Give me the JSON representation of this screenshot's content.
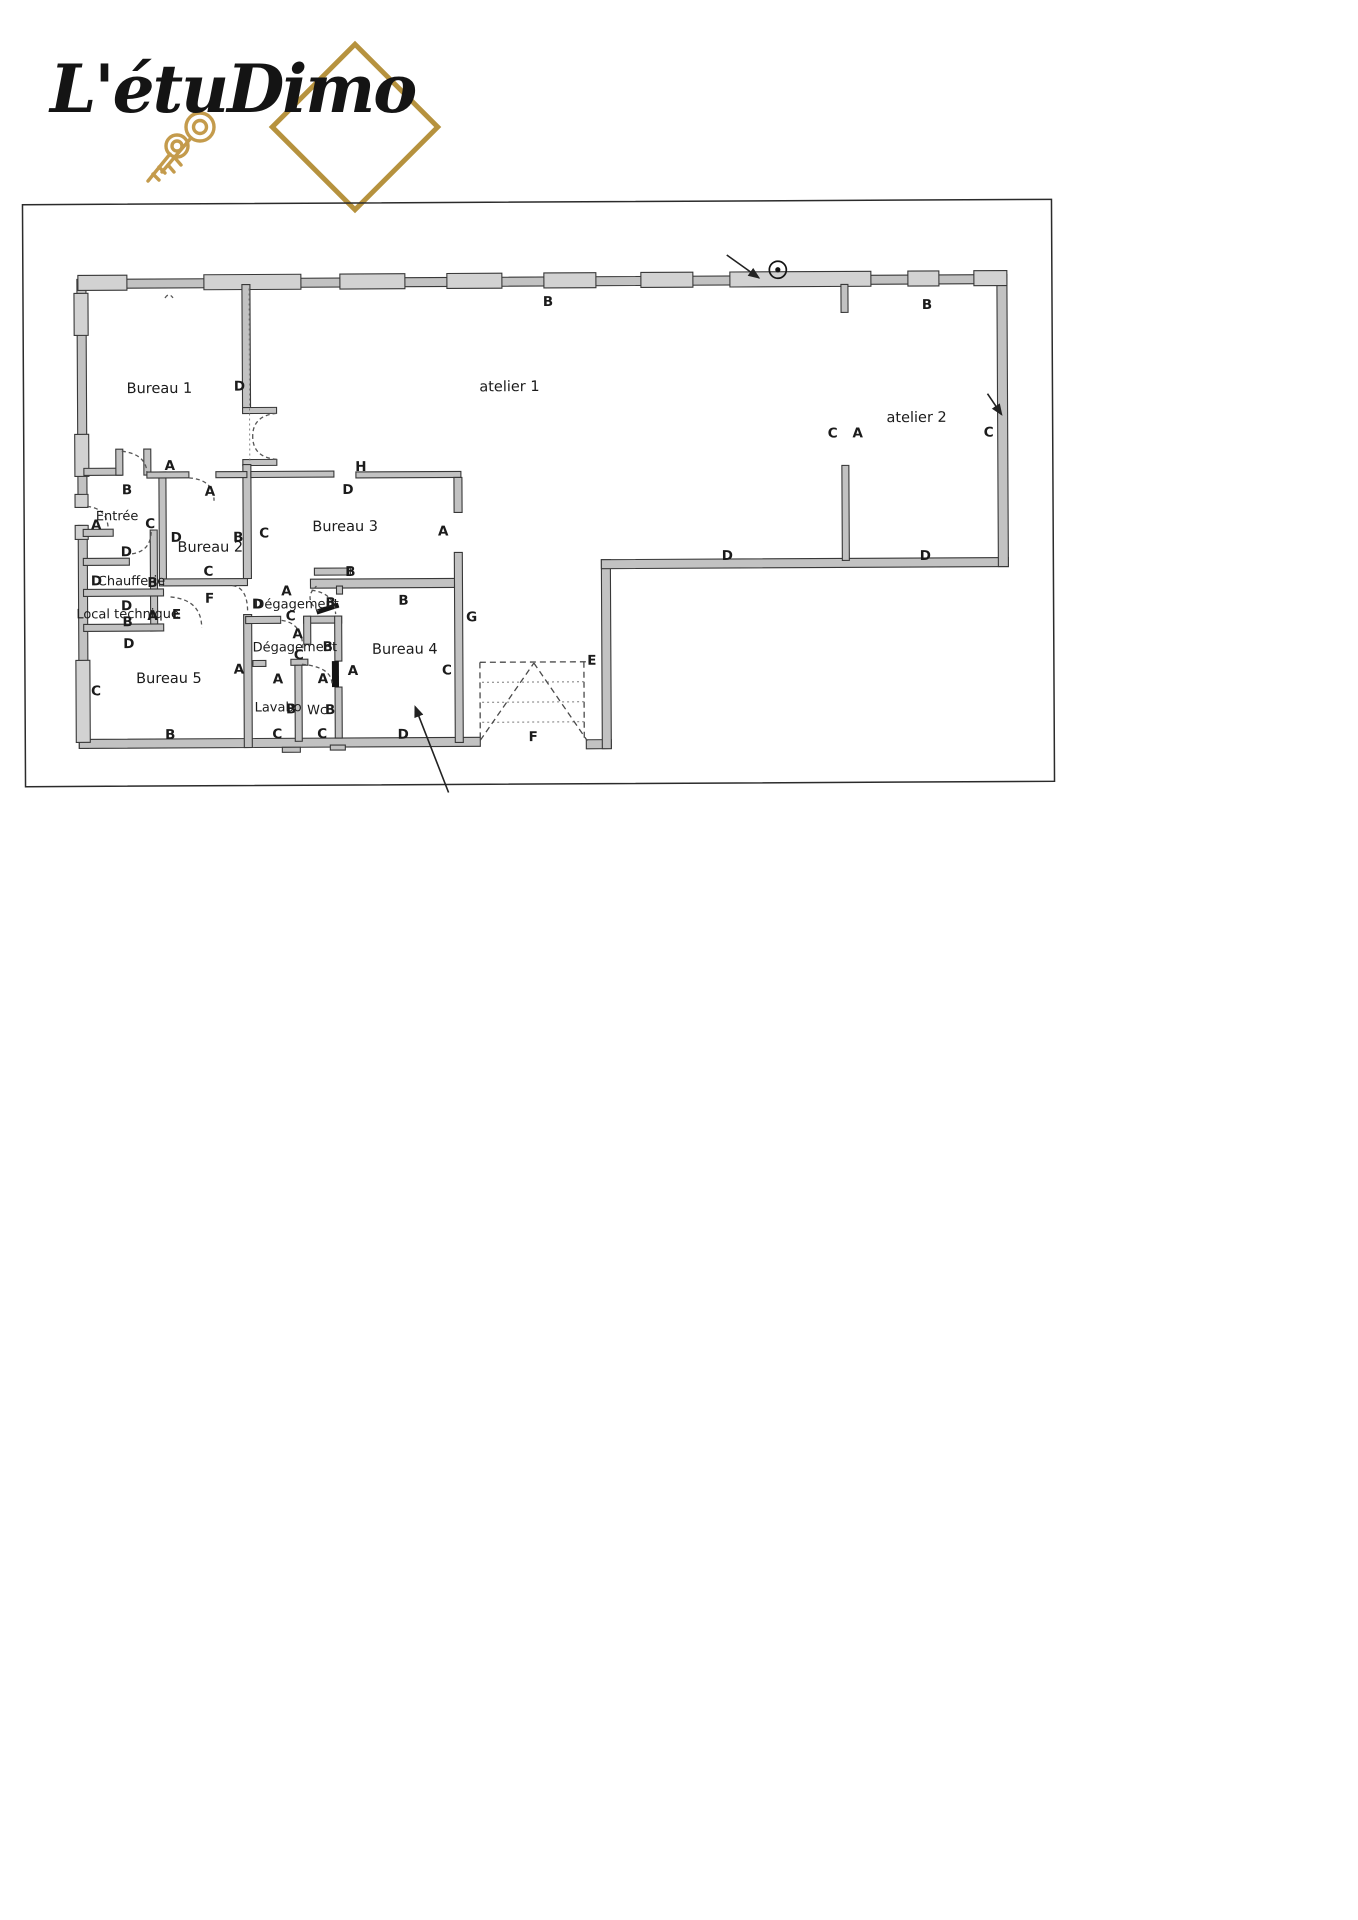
{
  "logo": {
    "text": "L'étuDimo"
  },
  "colors": {
    "brand_gold": "#b6923e",
    "wall_fill": "#c2c2c2",
    "ink": "#1b1b1b"
  },
  "plan": {
    "room_labels": [
      {
        "text": "Bureau 1",
        "x": 160,
        "y": 386
      },
      {
        "text": "Bureau 2",
        "x": 210,
        "y": 545
      },
      {
        "text": "Bureau 3",
        "x": 345,
        "y": 525
      },
      {
        "text": "Bureau 4",
        "x": 404,
        "y": 648
      },
      {
        "text": "Bureau 5",
        "x": 168,
        "y": 676
      },
      {
        "text": "atelier 1",
        "x": 510,
        "y": 386
      },
      {
        "text": "atelier 2",
        "x": 917,
        "y": 419
      },
      {
        "text": "Entrée",
        "x": 117,
        "y": 513,
        "small": true
      },
      {
        "text": "Chaufferie",
        "x": 131,
        "y": 578,
        "small": true
      },
      {
        "text": "Local technique",
        "x": 127,
        "y": 611,
        "small": true
      },
      {
        "text": "Dégagement",
        "x": 296,
        "y": 602,
        "small": true
      },
      {
        "text": "Dégagement",
        "x": 294,
        "y": 645,
        "small": true
      },
      {
        "text": "Lavabo",
        "x": 277,
        "y": 705,
        "small": true
      },
      {
        "text": "Wc",
        "x": 316,
        "y": 708,
        "small": true
      }
    ],
    "wall_letters": [
      {
        "text": "B",
        "x": 549,
        "y": 301
      },
      {
        "text": "B",
        "x": 928,
        "y": 306
      },
      {
        "text": "C",
        "x": 833,
        "y": 434
      },
      {
        "text": "A",
        "x": 858,
        "y": 434
      },
      {
        "text": "C",
        "x": 989,
        "y": 434
      },
      {
        "text": "D",
        "x": 727,
        "y": 556
      },
      {
        "text": "D",
        "x": 925,
        "y": 557
      },
      {
        "text": "D",
        "x": 240,
        "y": 384
      },
      {
        "text": "A",
        "x": 170,
        "y": 463
      },
      {
        "text": "H",
        "x": 361,
        "y": 465
      },
      {
        "text": "D",
        "x": 348,
        "y": 488
      },
      {
        "text": "A",
        "x": 210,
        "y": 489
      },
      {
        "text": "B",
        "x": 127,
        "y": 487
      },
      {
        "text": "A",
        "x": 96,
        "y": 522
      },
      {
        "text": "C",
        "x": 150,
        "y": 521
      },
      {
        "text": "D",
        "x": 126,
        "y": 549
      },
      {
        "text": "D",
        "x": 176,
        "y": 535
      },
      {
        "text": "B",
        "x": 238,
        "y": 535
      },
      {
        "text": "C",
        "x": 264,
        "y": 531
      },
      {
        "text": "A",
        "x": 443,
        "y": 530
      },
      {
        "text": "C",
        "x": 208,
        "y": 569
      },
      {
        "text": "B",
        "x": 350,
        "y": 570
      },
      {
        "text": "D",
        "x": 96,
        "y": 578
      },
      {
        "text": "B",
        "x": 152,
        "y": 580
      },
      {
        "text": "F",
        "x": 209,
        "y": 596
      },
      {
        "text": "B",
        "x": 403,
        "y": 599
      },
      {
        "text": "D",
        "x": 126,
        "y": 603
      },
      {
        "text": "B",
        "x": 127,
        "y": 619
      },
      {
        "text": "A",
        "x": 152,
        "y": 613
      },
      {
        "text": "E",
        "x": 176,
        "y": 612
      },
      {
        "text": "A",
        "x": 286,
        "y": 589
      },
      {
        "text": "D",
        "x": 257,
        "y": 602
      },
      {
        "text": "B",
        "x": 330,
        "y": 601
      },
      {
        "text": "C",
        "x": 290,
        "y": 614
      },
      {
        "text": "G",
        "x": 471,
        "y": 616
      },
      {
        "text": "D",
        "x": 128,
        "y": 641
      },
      {
        "text": "A",
        "x": 297,
        "y": 632
      },
      {
        "text": "B",
        "x": 327,
        "y": 645
      },
      {
        "text": "C",
        "x": 298,
        "y": 653
      },
      {
        "text": "A",
        "x": 238,
        "y": 667
      },
      {
        "text": "A",
        "x": 277,
        "y": 677
      },
      {
        "text": "A",
        "x": 322,
        "y": 677
      },
      {
        "text": "A",
        "x": 352,
        "y": 669
      },
      {
        "text": "C",
        "x": 95,
        "y": 688
      },
      {
        "text": "C",
        "x": 446,
        "y": 669
      },
      {
        "text": "E",
        "x": 591,
        "y": 660
      },
      {
        "text": "B",
        "x": 290,
        "y": 707
      },
      {
        "text": "B",
        "x": 329,
        "y": 708
      },
      {
        "text": "B",
        "x": 169,
        "y": 732
      },
      {
        "text": "C",
        "x": 276,
        "y": 732
      },
      {
        "text": "C",
        "x": 321,
        "y": 732
      },
      {
        "text": "D",
        "x": 402,
        "y": 733
      },
      {
        "text": "F",
        "x": 532,
        "y": 736
      }
    ]
  }
}
